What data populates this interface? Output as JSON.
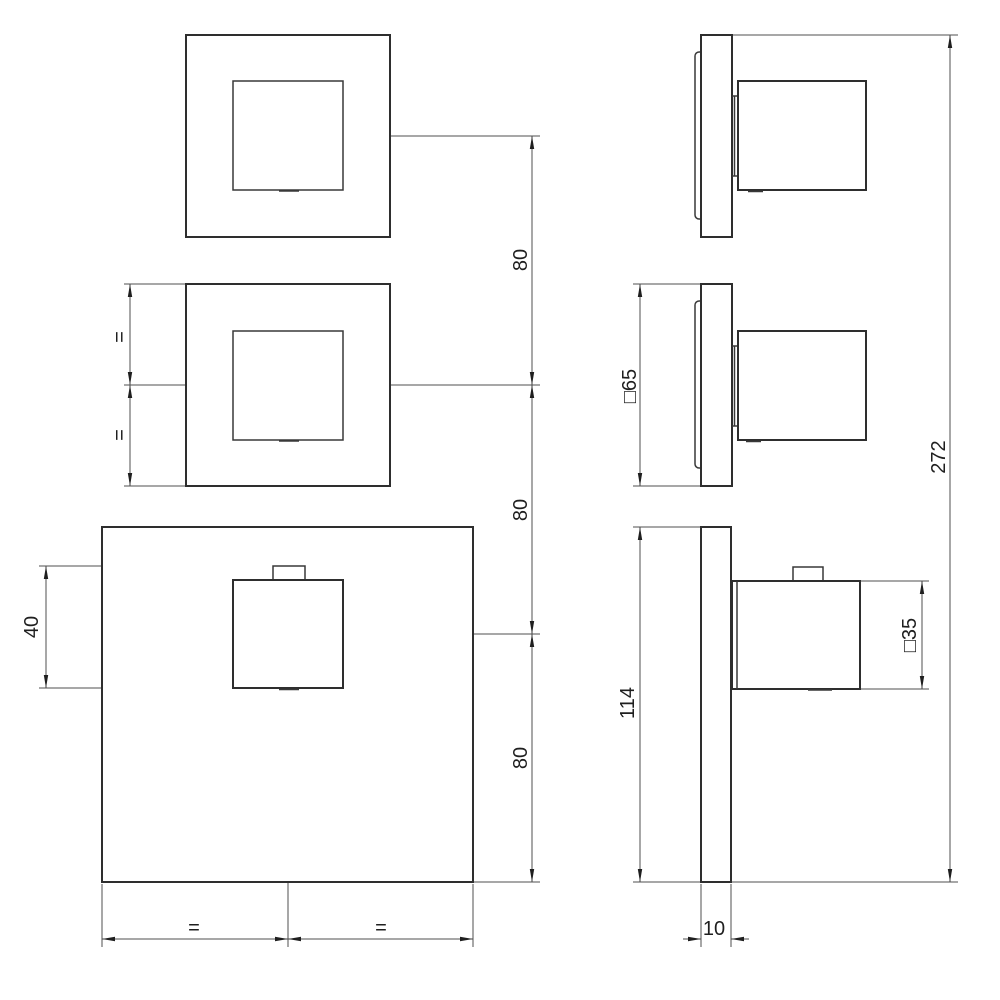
{
  "colors": {
    "background": "#ffffff",
    "part_outline": "#2e2e2e",
    "dimension_line": "#4f4f4f",
    "text": "#1f1f1f"
  },
  "labels": {
    "spacing_upper": "80",
    "spacing_middle": "80",
    "spacing_lower": "80",
    "handle_height": "40",
    "small_plate_square": "□65",
    "handle_square": "□35",
    "overall_height": "272",
    "large_plate_height": "114",
    "plate_depth": "10",
    "equal_height_upper": "=",
    "equal_height_lower": "=",
    "equal_width_left": "=",
    "equal_width_right": "="
  }
}
